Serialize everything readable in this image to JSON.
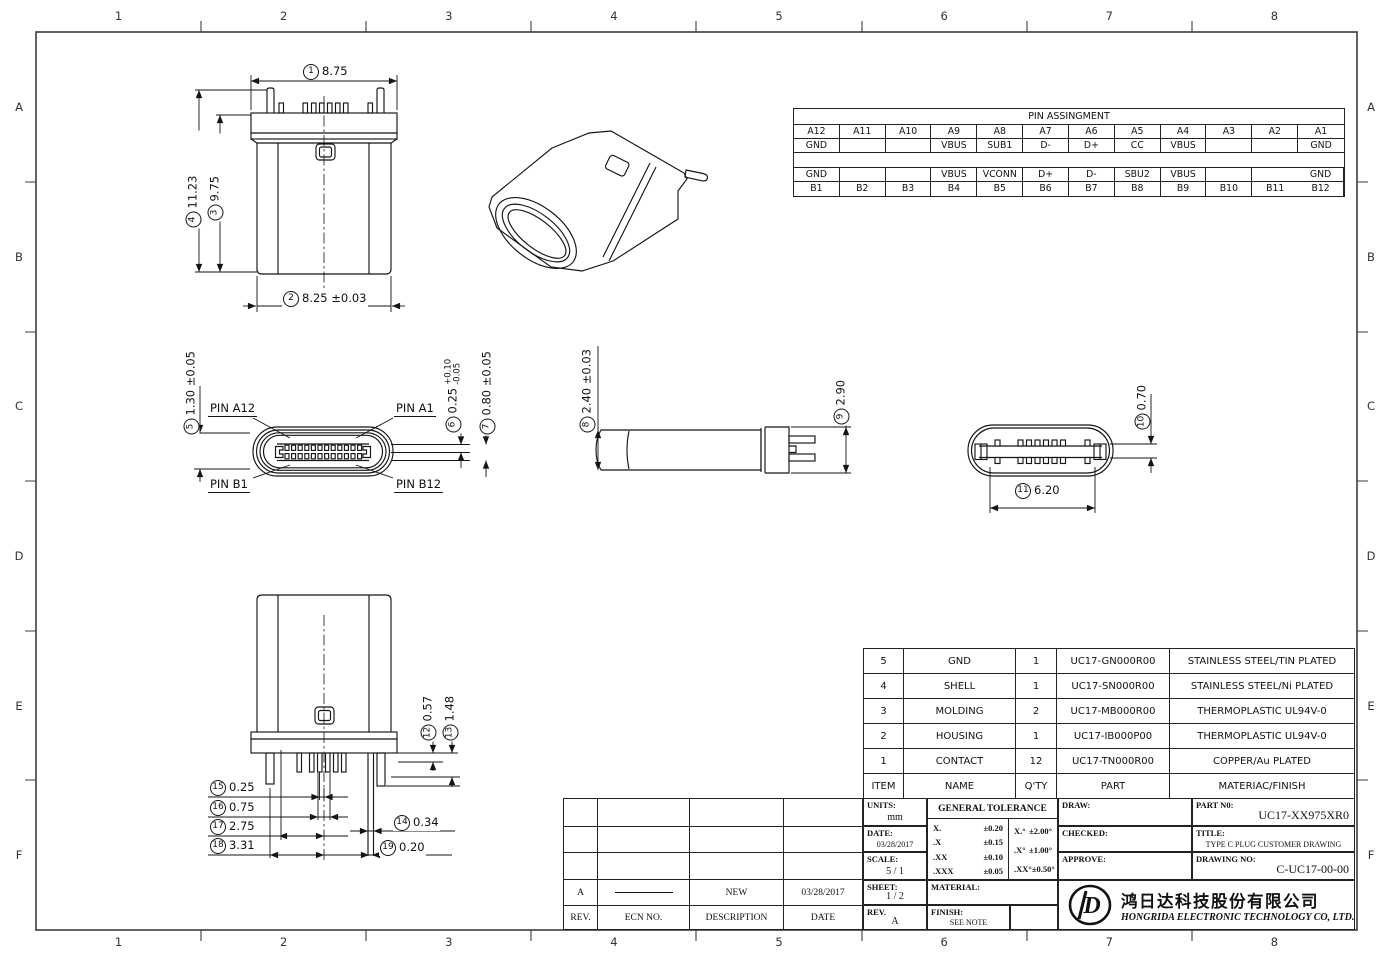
{
  "frame": {
    "columns": [
      "1",
      "2",
      "3",
      "4",
      "5",
      "6",
      "7",
      "8"
    ],
    "rows": [
      "A",
      "B",
      "C",
      "D",
      "E",
      "F"
    ]
  },
  "pin_table": {
    "title": "PIN ASSINGMENT",
    "rows": [
      [
        "A12",
        "A11",
        "A10",
        "A9",
        "A8",
        "A7",
        "A6",
        "A5",
        "A4",
        "A3",
        "A2",
        "A1"
      ],
      [
        "GND",
        "",
        "",
        "VBUS",
        "SUB1",
        "D-",
        "D+",
        "CC",
        "VBUS",
        "",
        "",
        "GND"
      ],
      [
        "",
        "",
        "",
        "",
        "",
        "",
        "",
        "",
        "",
        "",
        "",
        ""
      ],
      [
        "GND",
        "",
        "",
        "VBUS",
        "VCONN",
        "D+",
        "D-",
        "SBU2",
        "VBUS",
        "",
        "",
        "GND"
      ],
      [
        "B1",
        "B2",
        "B3",
        "B4",
        "B5",
        "B6",
        "B7",
        "B8",
        "B9",
        "B10",
        "B11",
        "B12"
      ]
    ]
  },
  "dims": {
    "d1": {
      "n": "1",
      "v": "8.75"
    },
    "d2": {
      "n": "2",
      "v": "8.25 ±0.03"
    },
    "d3": {
      "n": "3",
      "v": "9.75"
    },
    "d4": {
      "n": "4",
      "v": "11.23"
    },
    "d5": {
      "n": "5",
      "v": "1.30 ±0.05"
    },
    "d6": {
      "n": "6",
      "v": "0.25",
      "tp": "+0.10",
      "tm": "-0.05"
    },
    "d7": {
      "n": "7",
      "v": "0.80 ±0.05"
    },
    "d8": {
      "n": "8",
      "v": "2.40 ±0.03"
    },
    "d9": {
      "n": "9",
      "v": "2.90"
    },
    "d10": {
      "n": "10",
      "v": "0.70"
    },
    "d11": {
      "n": "11",
      "v": "6.20"
    },
    "d12": {
      "n": "12",
      "v": "0.57"
    },
    "d13": {
      "n": "13",
      "v": "1.48"
    },
    "d14": {
      "n": "14",
      "v": "0.34"
    },
    "d15": {
      "n": "15",
      "v": "0.25"
    },
    "d16": {
      "n": "16",
      "v": "0.75"
    },
    "d17": {
      "n": "17",
      "v": "2.75"
    },
    "d18": {
      "n": "18",
      "v": "3.31"
    },
    "d19": {
      "n": "19",
      "v": "0.20"
    }
  },
  "pin_labels": {
    "a12": "PIN A12",
    "a1": "PIN A1",
    "b1": "PIN B1",
    "b12": "PIN B12"
  },
  "bom": {
    "headers": [
      "ITEM",
      "NAME",
      "Q'TY",
      "PART",
      "MATERIAC/FINISH"
    ],
    "rows": [
      [
        "5",
        "GND",
        "1",
        "UC17-GN000R00",
        "STAINLESS STEEL/TIN PLATED"
      ],
      [
        "4",
        "SHELL",
        "1",
        "UC17-SN000R00",
        "STAINLESS STEEL/Ni PLATED"
      ],
      [
        "3",
        "MOLDING",
        "2",
        "UC17-MB000R00",
        "THERMOPLASTIC  UL94V-0"
      ],
      [
        "2",
        "HOUSING",
        "1",
        "UC17-IB000P00",
        "THERMOPLASTIC UL94V-0"
      ],
      [
        "1",
        "CONTACT",
        "12",
        "UC17-TN000R00",
        "COPPER/Au PLATED"
      ]
    ]
  },
  "revision": {
    "headers": {
      "rev": "REV.",
      "ecn": "ECN NO.",
      "description": "DESCRIPTION",
      "date": "DATE"
    },
    "entry": {
      "rev": "A",
      "description": "NEW",
      "date": "03/28/2017"
    }
  },
  "title_block": {
    "units_label": "UNITS:",
    "units_value": "mm",
    "date_label": "DATE:",
    "date_value": "03/28/2017",
    "scale_label": "SCALE:",
    "scale_value": "5 / 1",
    "sheet_label": "SHEET:",
    "sheet_value": "1 / 2",
    "rev_label": "REV.",
    "rev_value": "A",
    "tolerance_title": "GENERAL TOLERANCE",
    "tol_linear": [
      [
        "X.",
        "±0.20"
      ],
      [
        ".X",
        "±0.15"
      ],
      [
        ".XX",
        "±0.10"
      ],
      [
        ".XXX",
        "±0.05"
      ]
    ],
    "tol_angular": [
      [
        "X.°",
        "±2.00°"
      ],
      [
        ".X°",
        "±1.00°"
      ],
      [
        ".XX°",
        "±0.50°"
      ]
    ],
    "material_label": "MATERIAL:",
    "finish_label": "FINISH:",
    "finish_value": "SEE NOTE",
    "draw_label": "DRAW:",
    "checked_label": "CHECKED:",
    "approve_label": "APPROVE:",
    "part_no_label": "PART N0:",
    "part_no_value": "UC17-XX975XR0",
    "title_label": "TITLE:",
    "title_value": "TYPE C PLUG CUSTOMER DRAWING",
    "drawing_no_label": "DRAWING NO:",
    "drawing_no_value": "C-UC17-00-00",
    "company_cn": "鸿日达科技股份有限公司",
    "company_en": "HONGRIDA ELECTRONIC TECHNOLOGY CO, LTD.",
    "logo_letter": "D"
  }
}
